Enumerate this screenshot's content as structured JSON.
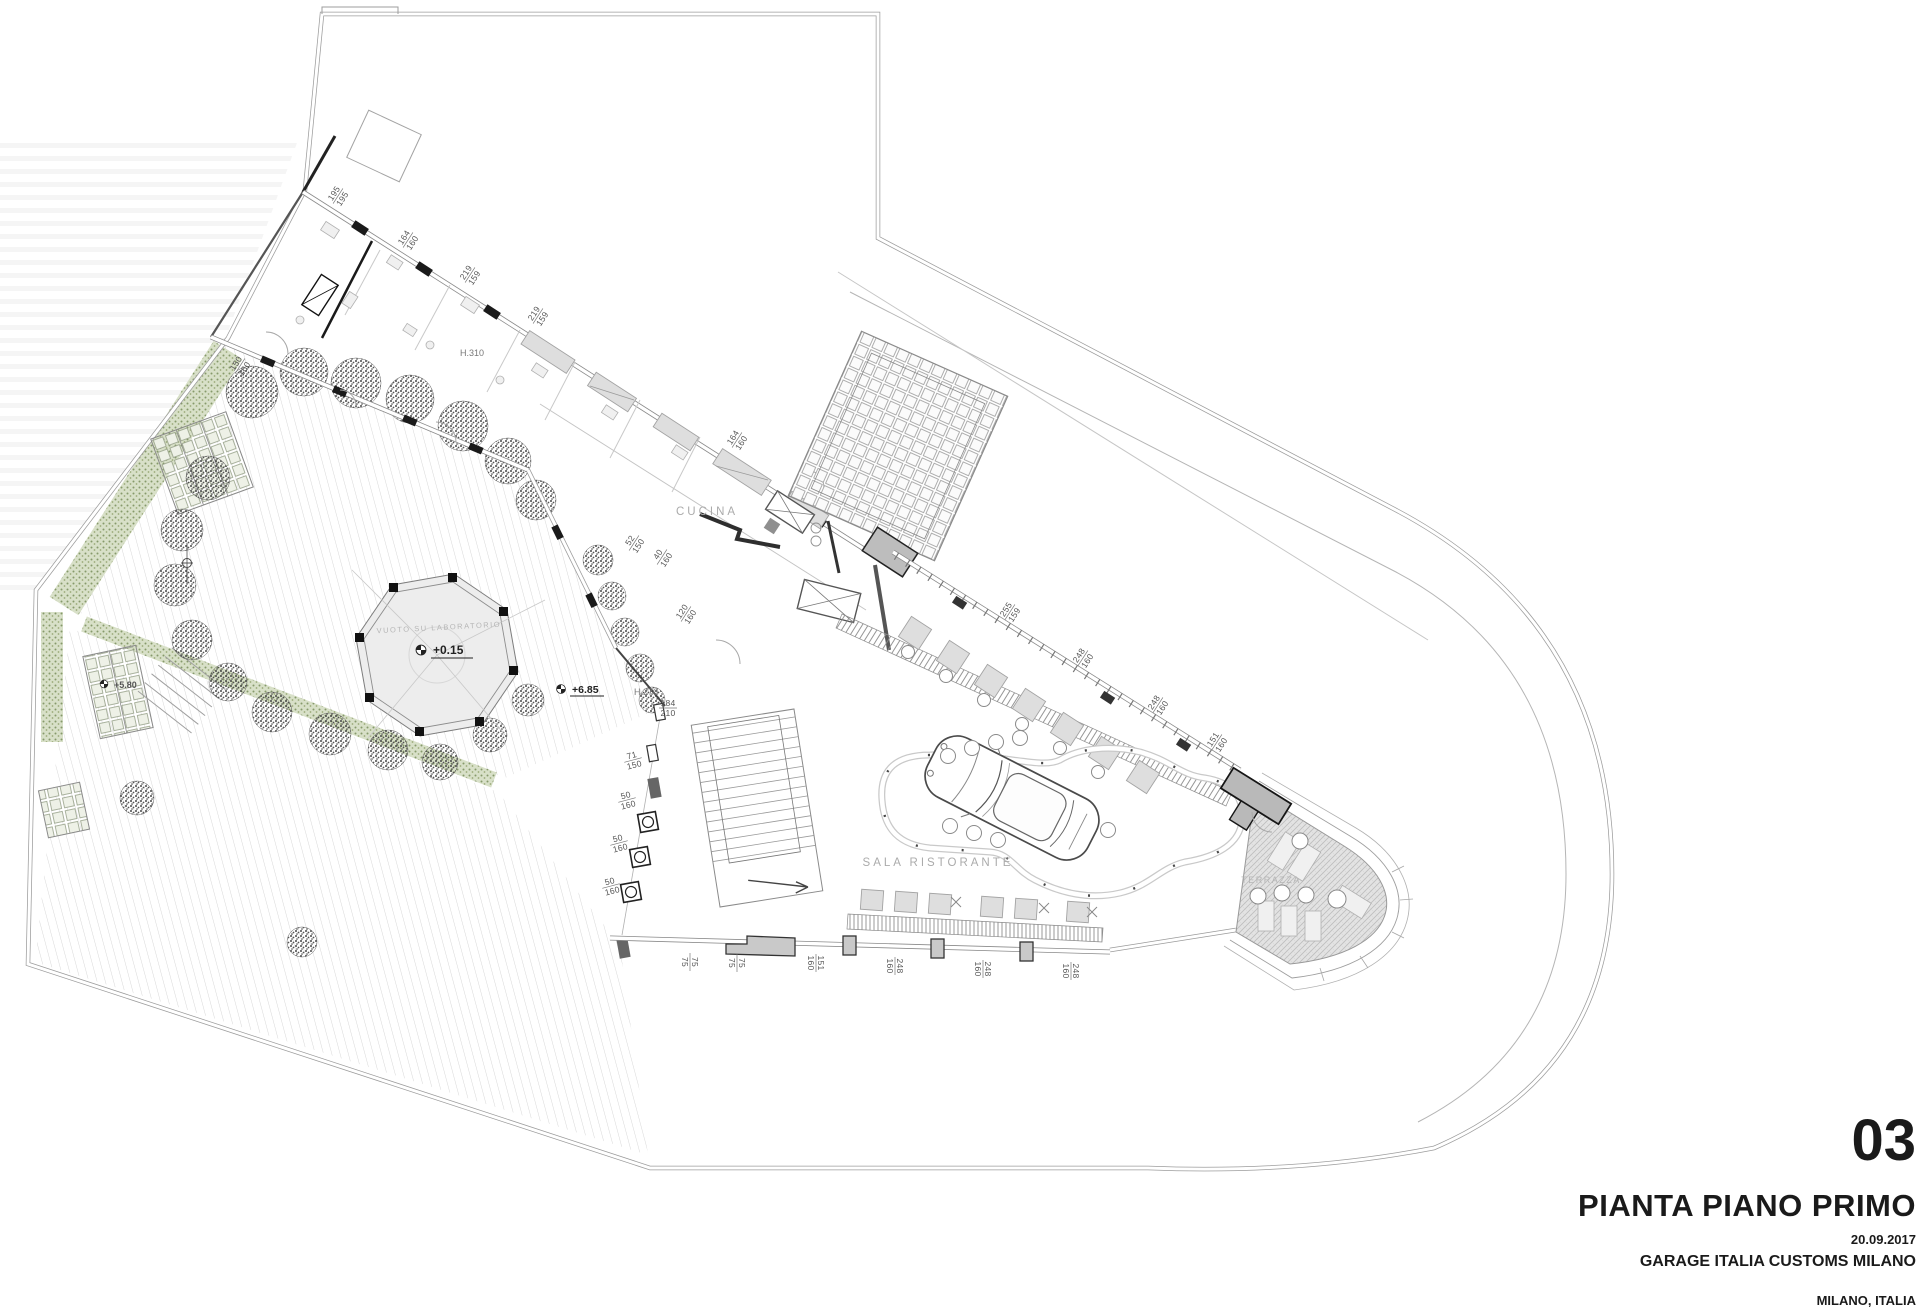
{
  "sheet": {
    "number": "03",
    "title": "PIANTA PIANO PRIMO",
    "date": "20.09.2017",
    "project": "GARAGE ITALIA CUSTOMS MILANO",
    "location": "MILANO, ITALIA"
  },
  "rooms": {
    "kitchen": "CUCINA",
    "dining": "SALA RISTORANTE",
    "terrace": "TERRAZZA",
    "void_label": "VUOTO SU LABORATORIO"
  },
  "levels": {
    "courtyard": "+0.15",
    "roof_garden": "+6.85",
    "lower_garden": "+5.80"
  },
  "heights": {
    "h_310": "H.310",
    "h_270": "H.270"
  },
  "dims": [
    {
      "w": "195",
      "h": "195"
    },
    {
      "w": "164",
      "h": "160"
    },
    {
      "w": "219",
      "h": "159"
    },
    {
      "w": "219",
      "h": "159"
    },
    {
      "w": "150",
      "h": "160"
    },
    {
      "w": "164",
      "h": "160"
    },
    {
      "w": "52",
      "h": "150"
    },
    {
      "w": "40",
      "h": "160"
    },
    {
      "w": "120",
      "h": "160"
    },
    {
      "w": "184",
      "h": "210"
    },
    {
      "w": "71",
      "h": "150"
    },
    {
      "w": "50",
      "h": "160"
    },
    {
      "w": "50",
      "h": "160"
    },
    {
      "w": "50",
      "h": "160"
    },
    {
      "w": "75",
      "h": "75"
    },
    {
      "w": "75",
      "h": "75"
    },
    {
      "w": "151",
      "h": "160"
    },
    {
      "w": "248",
      "h": "160"
    },
    {
      "w": "248",
      "h": "160"
    },
    {
      "w": "248",
      "h": "160"
    },
    {
      "w": "255",
      "h": "159"
    },
    {
      "w": "248",
      "h": "160"
    },
    {
      "w": "248",
      "h": "160"
    },
    {
      "w": "151",
      "h": "160"
    }
  ]
}
